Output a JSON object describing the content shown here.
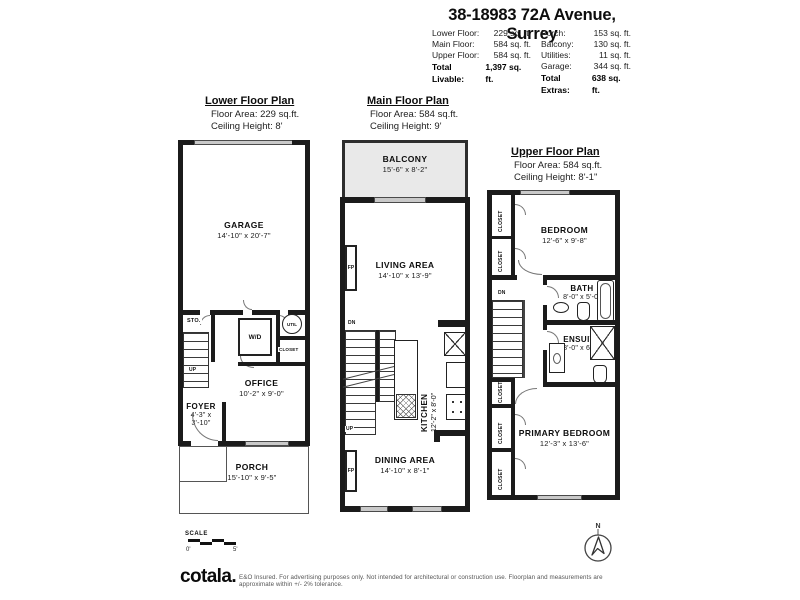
{
  "header": {
    "title": "38-18983 72A Avenue, Surrey",
    "livable": {
      "rows": [
        {
          "label": "Lower Floor:",
          "value": "229 sq. ft."
        },
        {
          "label": "Main Floor:",
          "value": "584 sq. ft."
        },
        {
          "label": "Upper Floor:",
          "value": "584 sq. ft."
        }
      ],
      "total_label": "Total Livable:",
      "total_value": "1,397 sq. ft."
    },
    "extras": {
      "rows": [
        {
          "label": "Porch:",
          "value": "153 sq. ft."
        },
        {
          "label": "Balcony:",
          "value": "130 sq. ft."
        },
        {
          "label": "Utilities:",
          "value": "11 sq. ft."
        },
        {
          "label": "Garage:",
          "value": "344 sq. ft."
        }
      ],
      "total_label": "Total Extras:",
      "total_value": "638 sq. ft."
    }
  },
  "lower": {
    "title": "Lower Floor Plan",
    "area": "Floor Area: 229 sq.ft.",
    "ceiling": "Ceiling Height: 8'",
    "garage": {
      "name": "GARAGE",
      "dims": "14'-10\" x 20'-7\""
    },
    "office": {
      "name": "OFFICE",
      "dims": "10'-2\" x 9'-0\""
    },
    "foyer": {
      "name": "FOYER",
      "dims1": "4'-3\" x",
      "dims2": "3'-10\""
    },
    "porch": {
      "name": "PORCH",
      "dims": "15'-10\" x 9'-5\""
    },
    "sto": "STO.",
    "wd": "W/D",
    "util": "UTIL",
    "closet": "CLOSET",
    "up": "UP"
  },
  "main": {
    "title": "Main Floor Plan",
    "area": "Floor Area: 584 sq.ft.",
    "ceiling": "Ceiling Height: 9'",
    "balcony": {
      "name": "BALCONY",
      "dims": "15'-6\" x 8'-2\""
    },
    "living": {
      "name": "LIVING AREA",
      "dims": "14'-10\" x 13'-9\""
    },
    "kitchen": {
      "name": "KITCHEN",
      "dims": "12'-2\" x 8'-0\""
    },
    "dining": {
      "name": "DINING AREA",
      "dims": "14'-10\" x 8'-1\""
    },
    "fp": "FP",
    "dn": "DN",
    "up": "UP"
  },
  "upper": {
    "title": "Upper Floor Plan",
    "area": "Floor Area: 584 sq.ft.",
    "ceiling": "Ceiling Height: 8'-1\"",
    "bedroom": {
      "name": "BEDROOM",
      "dims": "12'-6\" x 9'-8\""
    },
    "bath": {
      "name": "BATH",
      "dims": "8'-0\" x 5'-0\""
    },
    "ensuite": {
      "name": "ENSUITE",
      "dims": "8'-0\" x 6'-0\""
    },
    "primary": {
      "name": "PRIMARY BEDROOM",
      "dims": "12'-3\" x 13'-6\""
    },
    "closet": "CLOSET",
    "dn": "DN"
  },
  "scale": {
    "label": "SCALE",
    "start": "0'",
    "end": "5'"
  },
  "compass": {
    "n": "N"
  },
  "footer": {
    "logo": "cotala.",
    "disclaimer": "E&O Insured. For advertising purposes only. Not intended for architectural or construction use. Floorplan and measurements are approximate within +/- 2% tolerance."
  },
  "colors": {
    "wall": "#1b1b1b",
    "window": "#c9c9c9",
    "balcony_fill": "#e9e9e9"
  }
}
